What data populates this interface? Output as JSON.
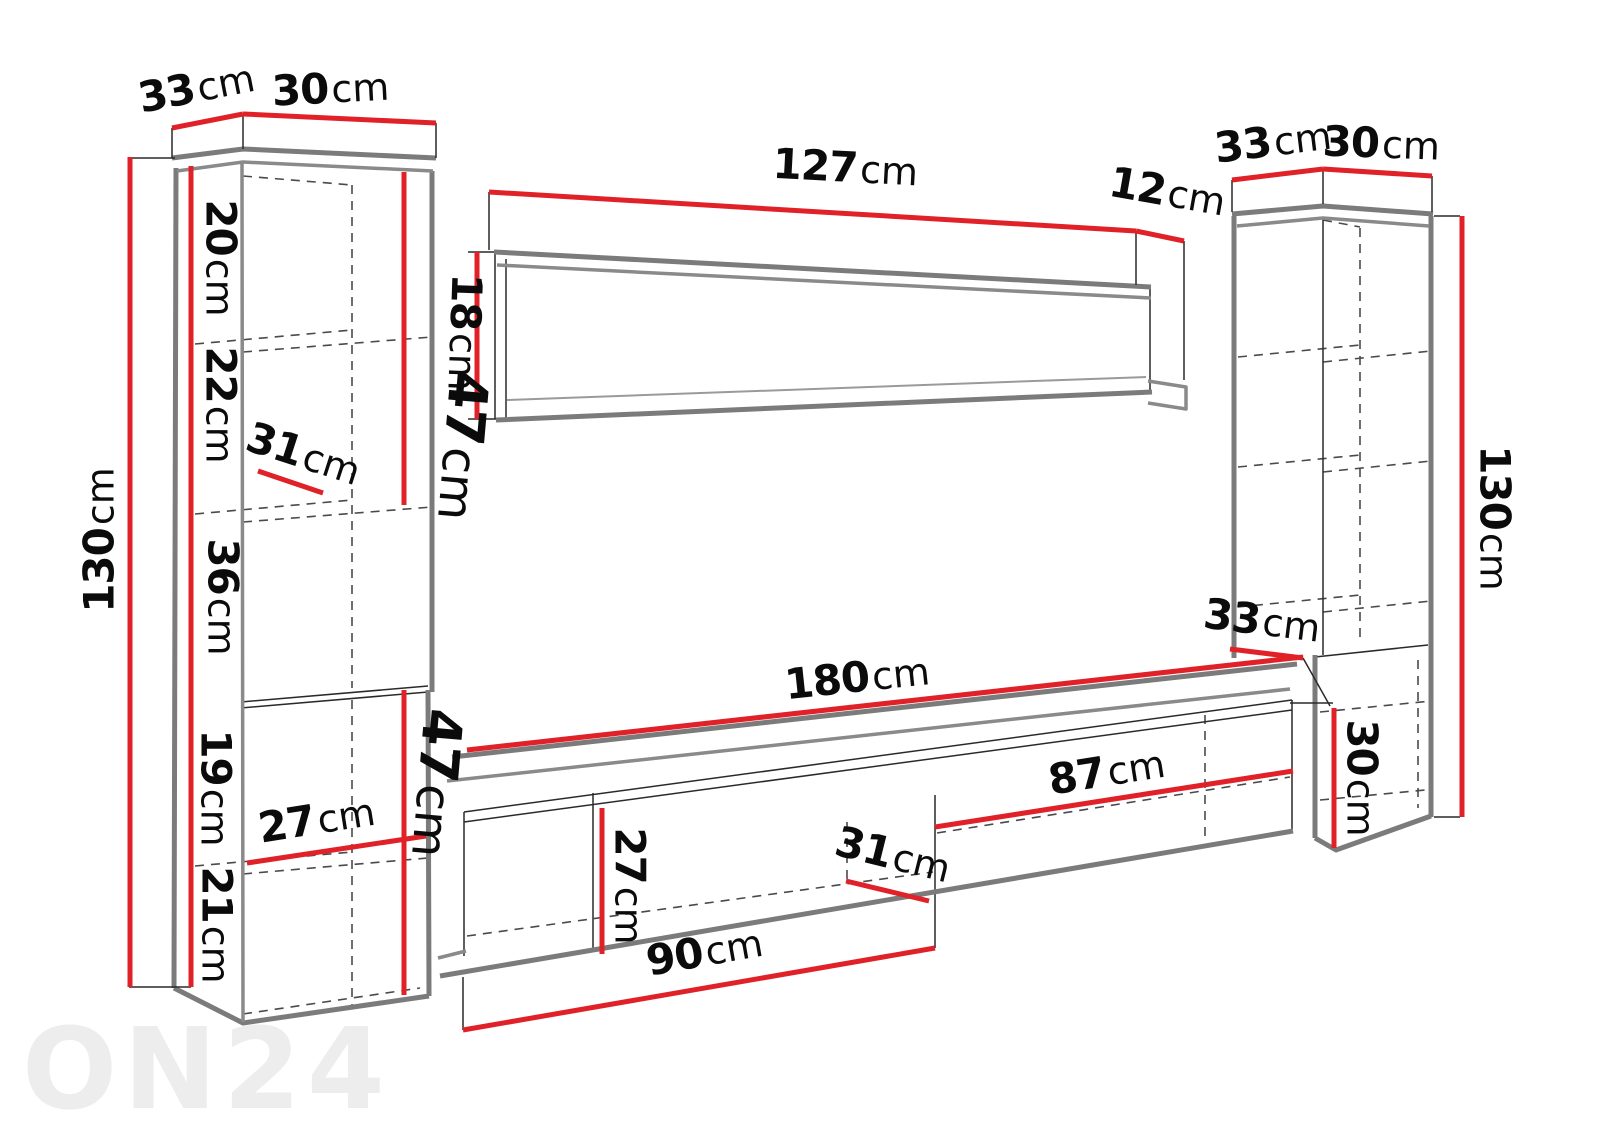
{
  "diagram": {
    "watermark": "ON24",
    "unit": "cm",
    "colors": {
      "dimension_line": "#e02127",
      "outline_gray": "#7b7b7b",
      "hidden_line": "#4a4a4a",
      "label_text": "#0b0b0b",
      "watermark_gray": "#ededed",
      "background": "#ffffff"
    },
    "labels": {
      "left_cabinet_depth": {
        "num": "33",
        "unit": "cm"
      },
      "left_cabinet_width": {
        "num": "30",
        "unit": "cm"
      },
      "left_cabinet_height": {
        "num": "130",
        "unit": "cm"
      },
      "left_section_1": {
        "num": "20",
        "unit": "cm"
      },
      "left_section_2": {
        "num": "22",
        "unit": "cm"
      },
      "left_shelf_depth": {
        "num": "31",
        "unit": "cm"
      },
      "left_section_3": {
        "num": "36",
        "unit": "cm"
      },
      "left_upper_inner_height": {
        "num": "47",
        "unit": "cm"
      },
      "left_section_4": {
        "num": "19",
        "unit": "cm"
      },
      "left_section_5": {
        "num": "21",
        "unit": "cm"
      },
      "left_lower_inner_height": {
        "num": "47",
        "unit": "cm"
      },
      "left_lower_depth": {
        "num": "27",
        "unit": "cm"
      },
      "shelf_length": {
        "num": "127",
        "unit": "cm"
      },
      "shelf_end_depth": {
        "num": "12",
        "unit": "cm"
      },
      "shelf_height": {
        "num": "18",
        "unit": "cm"
      },
      "right_cabinet_depth": {
        "num": "33",
        "unit": "cm"
      },
      "right_cabinet_width": {
        "num": "30",
        "unit": "cm"
      },
      "right_cabinet_height": {
        "num": "130",
        "unit": "cm"
      },
      "right_box_depth": {
        "num": "33",
        "unit": "cm"
      },
      "right_box_height": {
        "num": "30",
        "unit": "cm"
      },
      "tv_stand_length": {
        "num": "180",
        "unit": "cm"
      },
      "tv_stand_inner_length": {
        "num": "87",
        "unit": "cm"
      },
      "tv_stand_height": {
        "num": "27",
        "unit": "cm"
      },
      "tv_stand_depth": {
        "num": "31",
        "unit": "cm"
      },
      "tv_stand_left_length": {
        "num": "90",
        "unit": "cm"
      }
    }
  }
}
